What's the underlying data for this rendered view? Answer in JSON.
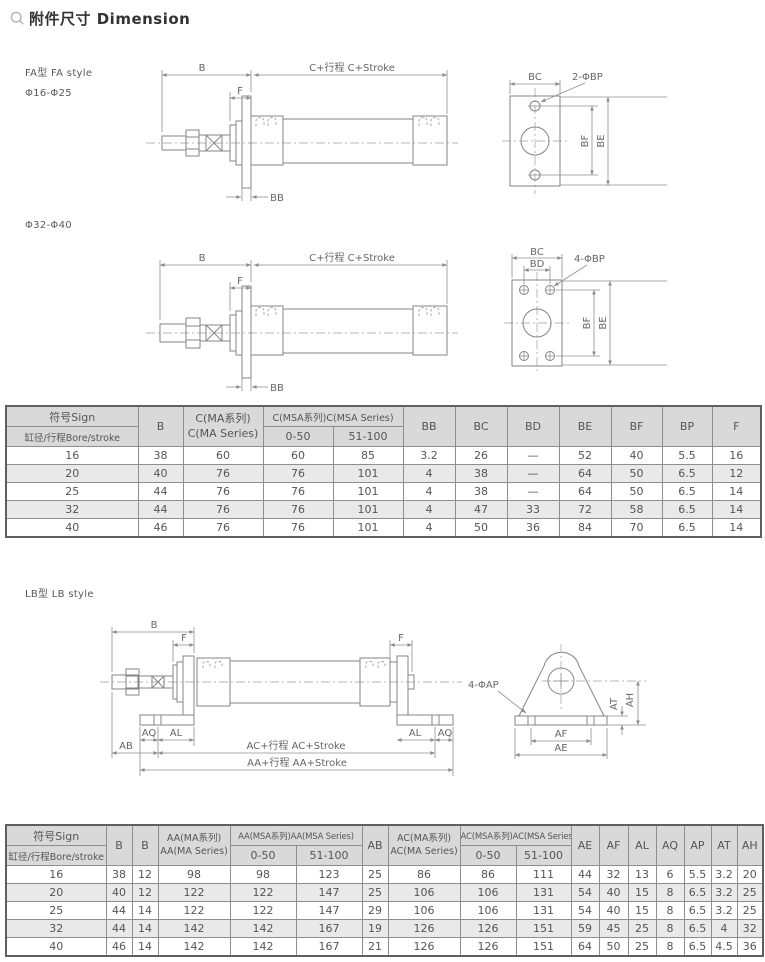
{
  "page": {
    "title": "附件尺寸 Dimension"
  },
  "fa": {
    "style_label": "FA型 FA style",
    "range_small": "Φ16-Φ25",
    "range_large": "Φ32-Φ40",
    "dims": {
      "b": "B",
      "f": "F",
      "c_stroke": "C+行程  C+Stroke",
      "bb": "BB",
      "bc": "BC",
      "bd": "BD",
      "bp2": "2-ΦBP",
      "bp4": "4-ΦBP",
      "bf": "BF",
      "be": "BE"
    }
  },
  "lb": {
    "style_label": "LB型 LB style",
    "dims": {
      "b": "B",
      "f": "F",
      "aq": "AQ",
      "al": "AL",
      "ab": "AB",
      "ac_stroke": "AC+行程  AC+Stroke",
      "aa_stroke": "AA+行程  AA+Stroke",
      "ap4": "4-ΦAP",
      "at": "AT",
      "ah": "AH",
      "af": "AF",
      "ae": "AE"
    }
  },
  "table_fa": {
    "header": {
      "sign": "符号Sign",
      "bore": "缸径/行程Bore/stroke",
      "b": "B",
      "c_ma_1": "C(MA系列)",
      "c_ma_2": "C(MA Series)",
      "c_msa": "C(MSA系列)C(MSA Series)",
      "range_a": "0-50",
      "range_b": "51-100",
      "cols": [
        "BB",
        "BC",
        "BD",
        "BE",
        "BF",
        "BP",
        "F"
      ]
    },
    "rows": [
      [
        "16",
        "38",
        "60",
        "60",
        "85",
        "3.2",
        "26",
        "—",
        "52",
        "40",
        "5.5",
        "16"
      ],
      [
        "20",
        "40",
        "76",
        "76",
        "101",
        "4",
        "38",
        "—",
        "64",
        "50",
        "6.5",
        "12"
      ],
      [
        "25",
        "44",
        "76",
        "76",
        "101",
        "4",
        "38",
        "—",
        "64",
        "50",
        "6.5",
        "14"
      ],
      [
        "32",
        "44",
        "76",
        "76",
        "101",
        "4",
        "47",
        "33",
        "72",
        "58",
        "6.5",
        "14"
      ],
      [
        "40",
        "46",
        "76",
        "76",
        "101",
        "4",
        "50",
        "36",
        "84",
        "70",
        "6.5",
        "14"
      ]
    ]
  },
  "table_lb": {
    "header": {
      "sign": "符号Sign",
      "bore": "缸径/行程Bore/stroke",
      "b1": "B",
      "b2": "B",
      "aa_ma_1": "AA(MA系列)",
      "aa_ma_2": "AA(MA Series)",
      "aa_msa": "AA(MSA系列)AA(MSA Series)",
      "range_a": "0-50",
      "range_b": "51-100",
      "ab": "AB",
      "ac_ma_1": "AC(MA系列)",
      "ac_ma_2": "AC(MA Series)",
      "ac_msa": "AC(MSA系列)AC(MSA Series)",
      "range_c": "0-50",
      "range_d": "51-100",
      "cols": [
        "AE",
        "AF",
        "AL",
        "AQ",
        "AP",
        "AT",
        "AH"
      ]
    },
    "rows": [
      [
        "16",
        "38",
        "12",
        "98",
        "98",
        "123",
        "25",
        "86",
        "86",
        "111",
        "44",
        "32",
        "13",
        "6",
        "5.5",
        "3.2",
        "20"
      ],
      [
        "20",
        "40",
        "12",
        "122",
        "122",
        "147",
        "25",
        "106",
        "106",
        "131",
        "54",
        "40",
        "15",
        "8",
        "6.5",
        "3.2",
        "25"
      ],
      [
        "25",
        "44",
        "14",
        "122",
        "122",
        "147",
        "29",
        "106",
        "106",
        "131",
        "54",
        "40",
        "15",
        "8",
        "6.5",
        "3.2",
        "25"
      ],
      [
        "32",
        "44",
        "14",
        "142",
        "142",
        "167",
        "19",
        "126",
        "126",
        "151",
        "59",
        "45",
        "25",
        "8",
        "6.5",
        "4",
        "32"
      ],
      [
        "40",
        "46",
        "14",
        "142",
        "142",
        "167",
        "21",
        "126",
        "126",
        "151",
        "64",
        "50",
        "25",
        "8",
        "6.5",
        "4.5",
        "36"
      ]
    ]
  }
}
